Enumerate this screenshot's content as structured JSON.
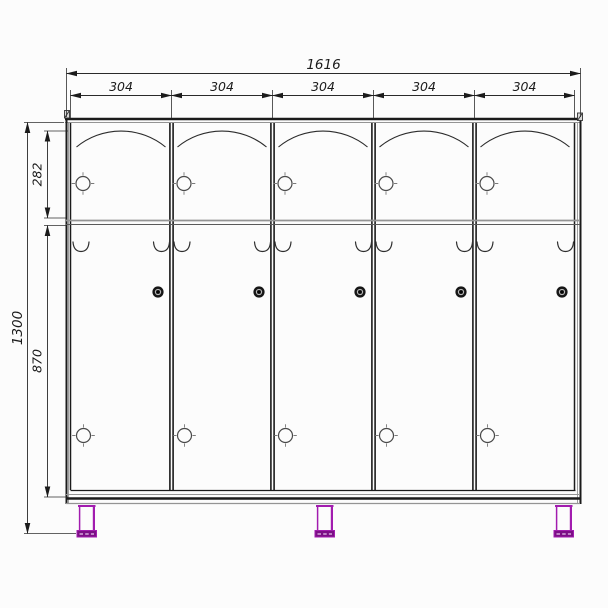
{
  "labels": {
    "total_width": "1616",
    "door_widths": [
      "304",
      "304",
      "304",
      "304",
      "304"
    ],
    "upper_door_height": "282",
    "lower_door_height": "870",
    "total_height": "1300"
  },
  "colors": {
    "line": "#1b1b1b",
    "secondary_line": "#949494",
    "leg_accent": "#a21caf",
    "leg_foot": "#7c0f86",
    "background": "#fcfcfc"
  },
  "counts": {
    "doors": 5,
    "legs": 3,
    "hooks_per_door": 2
  }
}
